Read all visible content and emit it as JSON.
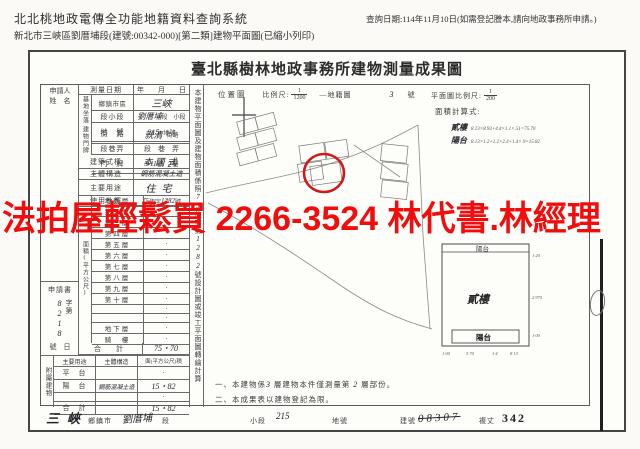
{
  "page": {
    "header": {
      "system_title": "北北桃地政電傳全功能地籍資料查詢系統",
      "doc_line": "新北市三峽區劉厝埔段(建號:00342-000)[第二類]建物平面圖(已縮小列印)",
      "query_date": "查詢日期:114年11月10日(如需登記謄本,請向地政事務所申請。)"
    },
    "watermark": "法拍屋輕鬆買 2266-3524 林代書.林經理"
  },
  "doc": {
    "title": "臺北縣樹林地政事務所建物測量成果圖",
    "form": {
      "applicant_l1": "申請人",
      "applicant_l2": "姓　名",
      "survey_label": "測量日期",
      "survey_value": "年　　月　　日",
      "site_group": "基地坐落",
      "site_town_label": "鄉鎮市區",
      "site_town_hand": "三峽",
      "site_sec_label": "段小段",
      "site_sec_hand": "劉厝埔",
      "site_sec_suffix": "段　小段",
      "site_lot_label": "地　號",
      "site_lot_hand": "215",
      "site_lot_suffix": "地號",
      "door_group": "建物門牌",
      "door_street_label": "街　路",
      "door_street_hand": "就清",
      "door_street_suffix": "街路",
      "door_lane_label": "段巷弄",
      "door_lane_value": "段　巷　弄",
      "door_no_label": "門　牌",
      "door_no_hand": "3-11",
      "door_no_mid": "號",
      "door_no_hand2": "2",
      "door_no_suffix": "樓",
      "style_label": "建築式樣",
      "style_hand": "本國式",
      "struct_label": "主體構造",
      "struct_hand": "鋼筋混凝土造",
      "use_label": "主要用途",
      "use_hand": "住宅",
      "license_label": "使用執照",
      "license_hand1": "75",
      "license_mid": "使字",
      "license_hand2": "1282",
      "license_suffix": "號",
      "area_group": "面積(平方公尺)",
      "floors": [
        {
          "label": "地面層",
          "value": "·"
        },
        {
          "label": "第二層",
          "value": "·"
        },
        {
          "label": "第三層",
          "value": "·"
        },
        {
          "label": "第四層",
          "value": "·"
        },
        {
          "label": "第五層",
          "value": "·"
        },
        {
          "label": "第六層",
          "value": "·"
        },
        {
          "label": "第七層",
          "value": "·"
        },
        {
          "label": "第八層",
          "value": "·"
        },
        {
          "label": "第九層",
          "value": "·"
        },
        {
          "label": "第十層",
          "value": "·"
        },
        {
          "label": "",
          "value": "·"
        },
        {
          "label": "",
          "value": "·"
        },
        {
          "label": "地下層",
          "value": "·"
        },
        {
          "label": "騎　樓",
          "value": "·"
        }
      ],
      "total_label": "合　計",
      "total_value": "75・70",
      "app_header": "申請書",
      "app_pre": "字第",
      "app_hand": "8218",
      "app_post": "號　日",
      "annex_group": "附屬建物",
      "annex_h1": "主要用途",
      "annex_h2": "主體構造",
      "annex_h3": "面(平方公尺)積",
      "annex_rows": [
        {
          "c1": "平　台",
          "c2": "",
          "c3": "·"
        },
        {
          "c1": "陽　台",
          "c2": "鋼筋混凝土造",
          "c3": "15・82"
        },
        {
          "c1": "",
          "c2": "",
          "c3": "·"
        },
        {
          "c1": "合　計",
          "c2": "",
          "c3": "15・82"
        }
      ]
    },
    "strip": {
      "t1": "本建物平面圖及建物面積係照",
      "h1": "75",
      "t2": "使字第",
      "h2": "1282",
      "t3": "號設計圖或竣工平面圖轉繪計算"
    },
    "locmap": {
      "label": "位置圖",
      "scale_label": "比例尺:",
      "num": "1",
      "den": "1200",
      "sheet": "—地籍圖",
      "sheet_hand": "3",
      "sheet_suffix": "號"
    },
    "plan": {
      "scale_label": "平面圖比例尺:",
      "num": "1",
      "den": "200",
      "calc_label": "面積計算式:",
      "calc1_name": "貳樓",
      "calc1_formula": "8.13×8.93+4.4×1.1×.51=75.70",
      "calc2_name": "陽台",
      "calc2_formula": "8.13×1.2+1.2×2.4+1.4×.9=15.82",
      "balcony_top": "陽台",
      "floor_label": "貳樓",
      "balcony_bottom": "陽台",
      "dim_r1": "1·20",
      "dim_r2": "2·975",
      "dim_r3": "1·00",
      "dim_b": [
        "1·00",
        "3·70",
        "1·4",
        "8·13"
      ]
    },
    "notes": {
      "n1a": "一、本建物係",
      "n1h": "3",
      "n1b": "層建物本件僅測量第",
      "n1h2": "2",
      "n1c": "層部份。",
      "n2": "二、本成果表以建物登記為限。"
    },
    "footer": {
      "town_hand": "三峽",
      "town": "鄉鎮市",
      "sec_hand": "劉厝埔",
      "sec": "段",
      "subsec": "小段",
      "subsec_hand": "215",
      "lot": "地號",
      "bno": "建號",
      "bno_hand": "08307",
      "fuzhang": "複丈",
      "fuzhang_no": "342"
    }
  }
}
